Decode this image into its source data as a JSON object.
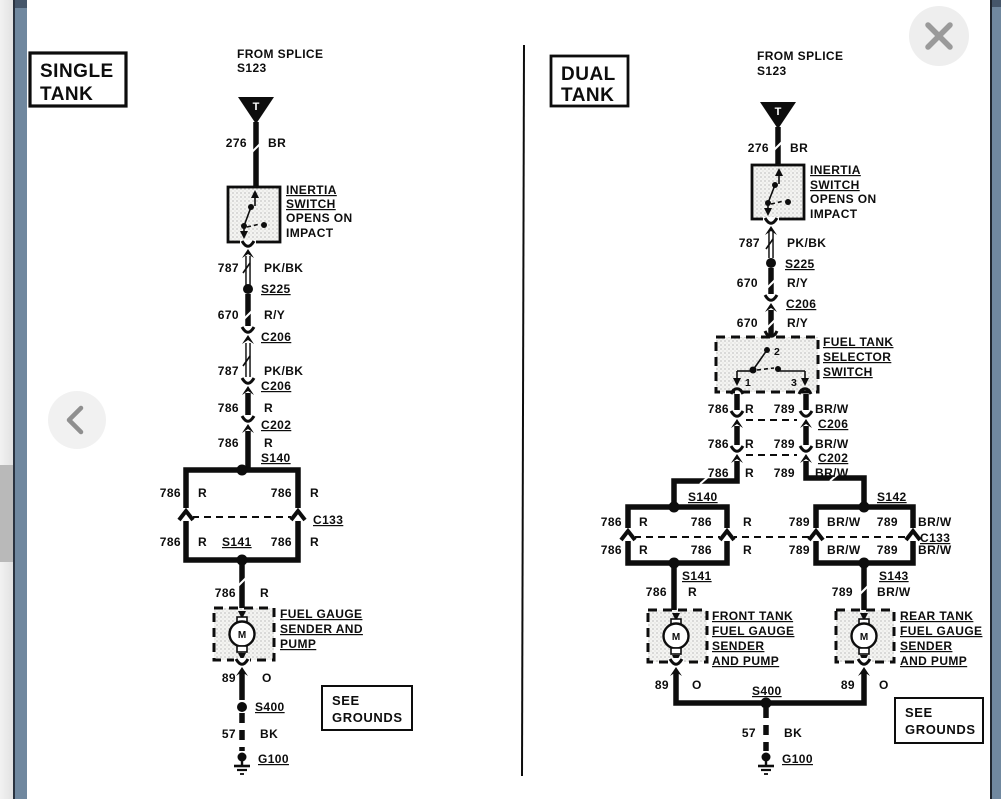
{
  "ui": {
    "close_button": {
      "icon": "close-icon",
      "glyph": "✕"
    },
    "back_button": {
      "icon": "chevron-left-icon",
      "glyph": "‹"
    }
  },
  "colors": {
    "ink": "#0d0d0d",
    "paper": "#ffffff",
    "sidebar_blue": "#70889f",
    "sidebar_blue_dark": "#45566a",
    "control_bg": "#eeeeee",
    "control_icon": "#9a9a9a",
    "scrollbar_thumb": "#b9b9b9"
  },
  "left": {
    "title": [
      "SINGLE",
      "TANK"
    ],
    "from_splice": [
      "FROM SPLICE",
      "S123"
    ],
    "splice_t": "T",
    "w276": [
      "276",
      "BR"
    ],
    "inertia": [
      "INERTIA",
      "SWITCH",
      "OPENS ON",
      "IMPACT"
    ],
    "w787a": [
      "787",
      "PK/BK"
    ],
    "s225": "S225",
    "w670": [
      "670",
      "R/Y"
    ],
    "c206a": "C206",
    "w787b": [
      "787",
      "PK/BK"
    ],
    "c206b": "C206",
    "w786a": [
      "786",
      "R"
    ],
    "c202": "C202",
    "w786b": [
      "786",
      "R"
    ],
    "s140": "S140",
    "box": {
      "ul": [
        "786",
        "R"
      ],
      "ur": [
        "786",
        "R"
      ],
      "ll": [
        "786",
        "R"
      ],
      "lr": [
        "786",
        "R"
      ]
    },
    "c133": "C133",
    "s141": "S141",
    "w786c": [
      "786",
      "R"
    ],
    "pump": {
      "label": [
        "FUEL GAUGE",
        "SENDER AND",
        "PUMP"
      ],
      "motor": "M"
    },
    "w89": [
      "89",
      "O"
    ],
    "s400": "S400",
    "w57": [
      "57",
      "BK"
    ],
    "g100": "G100",
    "see_grounds": [
      "SEE",
      "GROUNDS"
    ]
  },
  "right": {
    "title": [
      "DUAL",
      "TANK"
    ],
    "from_splice": [
      "FROM SPLICE",
      "S123"
    ],
    "splice_t": "T",
    "w276": [
      "276",
      "BR"
    ],
    "inertia": [
      "INERTIA",
      "SWITCH",
      "OPENS ON",
      "IMPACT"
    ],
    "w787": [
      "787",
      "PK/BK"
    ],
    "s225": "S225",
    "w670a": [
      "670",
      "R/Y"
    ],
    "c206a": "C206",
    "w670b": [
      "670",
      "R/Y"
    ],
    "selector": {
      "label": [
        "FUEL TANK",
        "SELECTOR",
        "SWITCH"
      ],
      "terminals": [
        "2",
        "1",
        "3"
      ]
    },
    "row1": [
      "786",
      "R",
      "789",
      "BR/W"
    ],
    "c206b": "C206",
    "row2": [
      "786",
      "R",
      "789",
      "BR/W"
    ],
    "c202": "C202",
    "row3": [
      "786",
      "R",
      "789",
      "BR/W"
    ],
    "s140": "S140",
    "s142": "S142",
    "lbox": {
      "ul": [
        "786",
        "R"
      ],
      "ur": [
        "786",
        "R"
      ],
      "ll": [
        "786",
        "R"
      ],
      "lr": [
        "786",
        "R"
      ]
    },
    "rbox": {
      "ul": [
        "789",
        "BR/W"
      ],
      "ur": [
        "789",
        "BR/W"
      ],
      "ll": [
        "789",
        "BR/W"
      ],
      "lr": [
        "789",
        "BR/W"
      ]
    },
    "c133": "C133",
    "s141": "S141",
    "s143": "S143",
    "w786": [
      "786",
      "R"
    ],
    "w789": [
      "789",
      "BR/W"
    ],
    "front_pump": {
      "label": [
        "FRONT TANK",
        "FUEL GAUGE",
        "SENDER",
        "AND PUMP"
      ],
      "motor": "M"
    },
    "rear_pump": {
      "label": [
        "REAR TANK",
        "FUEL GAUGE",
        "SENDER",
        "AND PUMP"
      ],
      "motor": "M"
    },
    "w89l": [
      "89",
      "O"
    ],
    "w89r": [
      "89",
      "O"
    ],
    "s400": "S400",
    "w57": [
      "57",
      "BK"
    ],
    "g100": "G100",
    "see_grounds": [
      "SEE",
      "GROUNDS"
    ]
  }
}
